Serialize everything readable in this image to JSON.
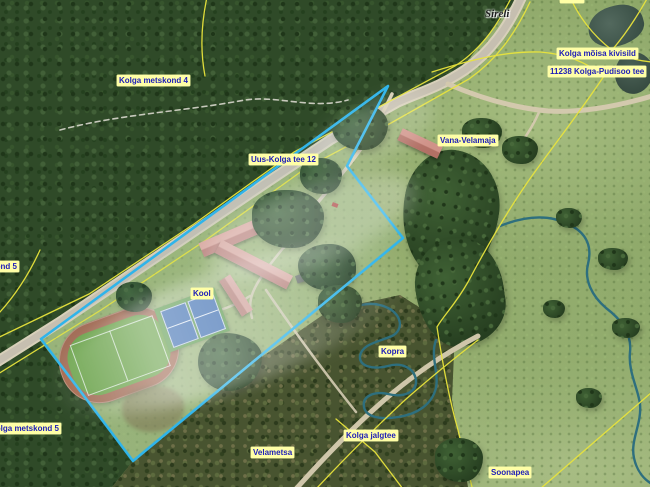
{
  "map": {
    "type": "aerial-orthophoto-with-cadastral-overlay",
    "colors": {
      "parcel_highlight": "#2fb4ea",
      "cadastral_line": "#e9e43c",
      "label_bg": "#ffffa6",
      "label_text": "#2020b8",
      "water": "#2e6f7e"
    },
    "labels": [
      {
        "id": "kolga-metskond-4",
        "text": "Kolga metskond 4",
        "x": 117,
        "y": 75,
        "type": "cad"
      },
      {
        "id": "sireli-place",
        "text": "Sireli",
        "x": 483,
        "y": 7,
        "type": "place"
      },
      {
        "id": "sireli-parcel",
        "text": "Sireli",
        "x": 560,
        "y": -8,
        "type": "cad"
      },
      {
        "id": "kolga-moisa-kivisild",
        "text": "Kolga mõisa kivisild",
        "x": 557,
        "y": 48,
        "type": "cad"
      },
      {
        "id": "kolga-pudisoo-tee",
        "text": "11238 Kolga-Pudisoo tee",
        "x": 548,
        "y": 66,
        "type": "cad"
      },
      {
        "id": "uus-kolga-tee-12",
        "text": "Uus-Kolga tee 12",
        "x": 249,
        "y": 154,
        "type": "cad"
      },
      {
        "id": "vana-velamaja",
        "text": "Vana-Velamaja",
        "x": 438,
        "y": 135,
        "type": "cad"
      },
      {
        "id": "kool",
        "text": "Kool",
        "x": 191,
        "y": 288,
        "type": "cad"
      },
      {
        "id": "kopra",
        "text": "Kopra",
        "x": 379,
        "y": 346,
        "type": "cad"
      },
      {
        "id": "kolga-metskond-5",
        "text": "Kolga metskond 5",
        "x": -12,
        "y": 423,
        "type": "cad"
      },
      {
        "id": "metskond-5-fragment",
        "text": "Kolga metskond 5",
        "x": -54,
        "y": 261,
        "type": "cad"
      },
      {
        "id": "velametsa",
        "text": "Velametsa",
        "x": 251,
        "y": 447,
        "type": "cad"
      },
      {
        "id": "kolga-jalgtee",
        "text": "Kolga jalgtee",
        "x": 344,
        "y": 430,
        "type": "cad"
      },
      {
        "id": "soonapea",
        "text": "Soonapea",
        "x": 489,
        "y": 467,
        "type": "cad"
      }
    ]
  }
}
